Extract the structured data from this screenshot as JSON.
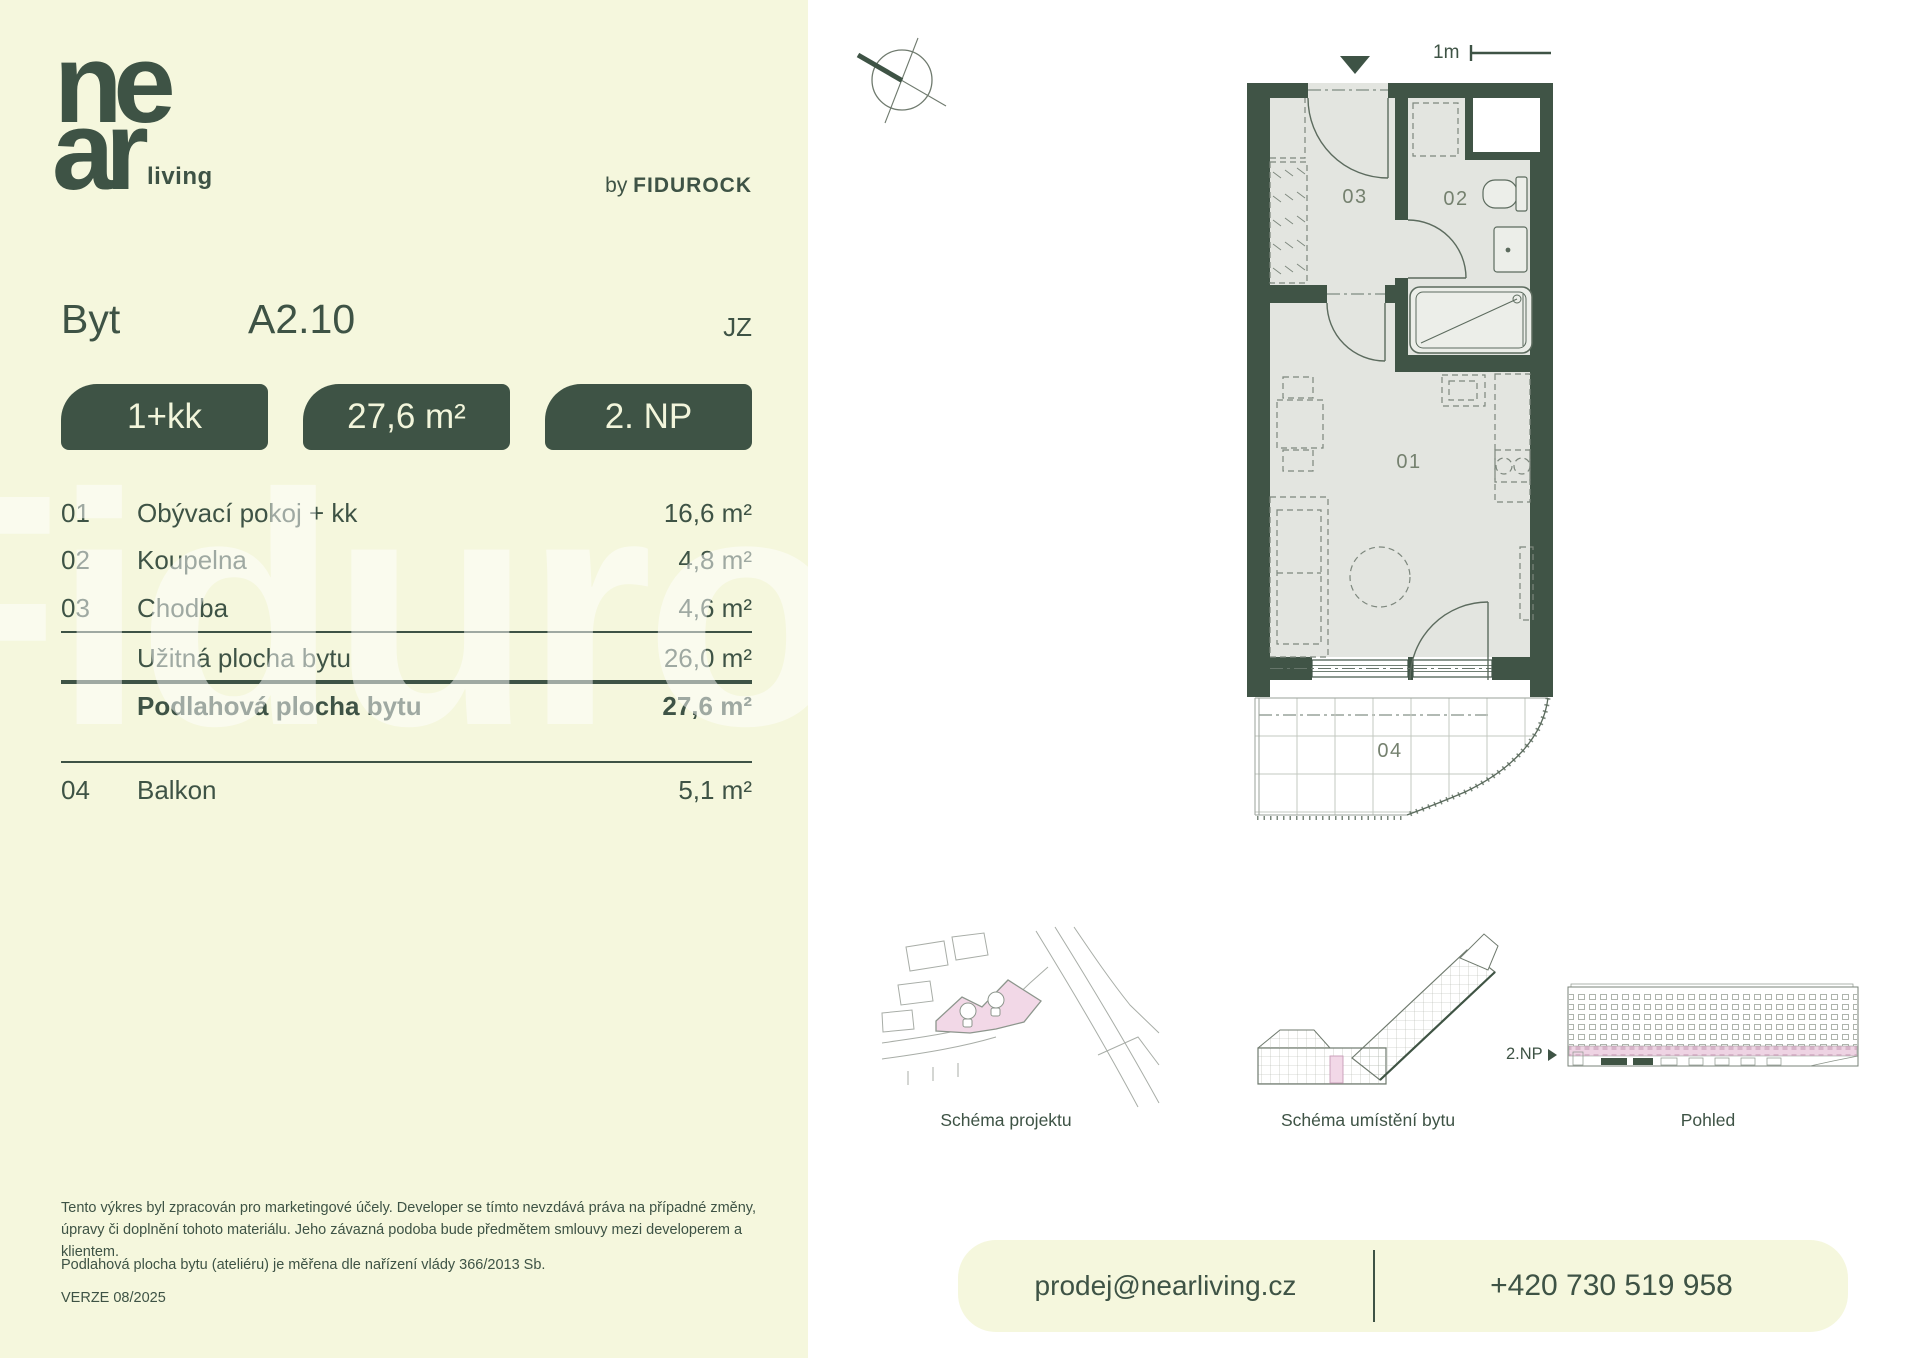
{
  "brand": {
    "logo_top": "ne",
    "logo_bottom": "ar",
    "logo_suffix": "living",
    "byline_prefix": "by",
    "byline_name": "FIDUROCK",
    "watermark": "Fidurock"
  },
  "header": {
    "type_label": "Byt",
    "unit_number": "A2.10",
    "orientation": "JZ"
  },
  "badges": [
    {
      "label": "1+kk"
    },
    {
      "label": "27,6 m²"
    },
    {
      "label": "2. NP"
    }
  ],
  "room_table": {
    "rows": [
      {
        "num": "01",
        "label": "Obývací pokoj + kk",
        "area": "16,6 m²"
      },
      {
        "num": "02",
        "label": "Koupelna",
        "area": "4,8 m²"
      },
      {
        "num": "03",
        "label": "Chodba",
        "area": "4,6 m²"
      }
    ],
    "usable": {
      "label": "Užitná plocha bytu",
      "area": "26,0 m²"
    },
    "total": {
      "label": "Podlahová plocha bytu",
      "area": "27,6 m²"
    },
    "balcony": {
      "num": "04",
      "label": "Balkon",
      "area": "5,1 m²"
    }
  },
  "plan": {
    "scale_label": "1m",
    "labels": {
      "r01": "01",
      "r02": "02",
      "r03": "03",
      "r04": "04"
    }
  },
  "diagrams": {
    "project_label": "Schéma projektu",
    "location_label": "Schéma umístění bytu",
    "elevation_label": "Pohled",
    "floor_marker": "2.NP"
  },
  "disclaimer": {
    "paragraph1": "Tento výkres byl zpracován pro marketingové účely. Developer se tímto nevzdává práva na případné změny, úpravy či doplnění tohoto materiálu. Jeho závazná podoba bude předmětem smlouvy mezi developerem a klientem.",
    "paragraph2": "Podlahová plocha bytu (ateliéru) je měřena dle nařízení vlády 366/2013 Sb.",
    "version": "VERZE 08/2025"
  },
  "contact": {
    "email": "prodej@nearliving.cz",
    "phone": "+420 730 519 958"
  },
  "colors": {
    "green": "#3e5345",
    "cream": "#f5f7dd",
    "floor_gray": "#e3e5e0",
    "pink": "#f2d8e7",
    "fixture_line": "#5c6b5e"
  }
}
